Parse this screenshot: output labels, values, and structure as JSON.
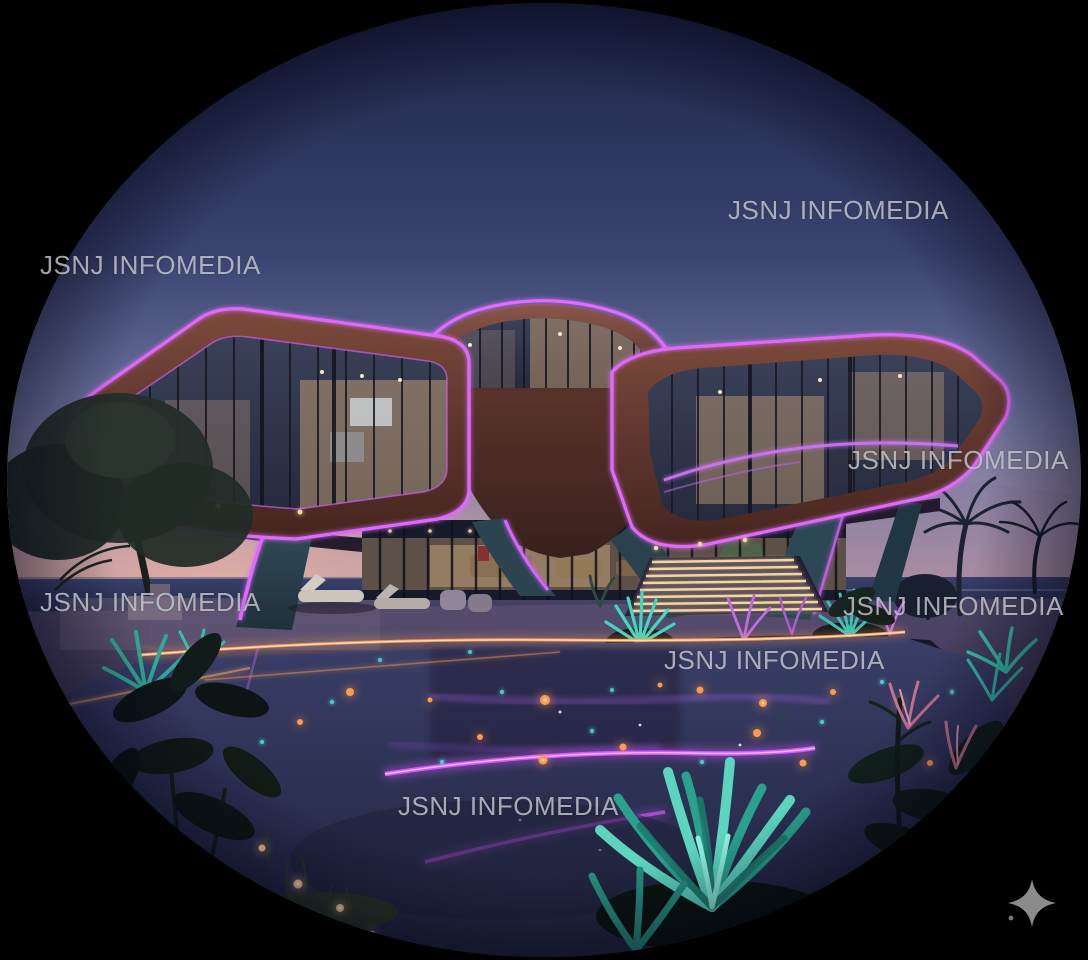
{
  "scene": {
    "kind": "photograph",
    "crop_shape": "circle on black background",
    "subject": "futuristic neon-lit villa at dusk with pool and glowing garden"
  },
  "watermarks": [
    {
      "id": "top-left",
      "text": "JSNJ INFOMEDIA"
    },
    {
      "id": "top-right",
      "text": "JSNJ INFOMEDIA"
    },
    {
      "id": "mid-right",
      "text": "JSNJ INFOMEDIA"
    },
    {
      "id": "mid-left",
      "text": "JSNJ INFOMEDIA"
    },
    {
      "id": "lower-right",
      "text": "JSNJ INFOMEDIA"
    },
    {
      "id": "center",
      "text": "JSNJ INFOMEDIA"
    },
    {
      "id": "bottom",
      "text": "JSNJ INFOMEDIA"
    }
  ],
  "icons": {
    "sparkle": "✦"
  },
  "colors": {
    "watermark-color": "#c5c7cd",
    "sparkle-color": "#8b8b8b",
    "bg": "#000000",
    "neon-purple": "#e06dff",
    "sky-top": "#1b2344",
    "sky-horizon-pink": "#c59aa1",
    "pool-orange-light": "#ff9a4d",
    "plant-teal": "#3fd8c4",
    "wood": "#5e362e"
  }
}
